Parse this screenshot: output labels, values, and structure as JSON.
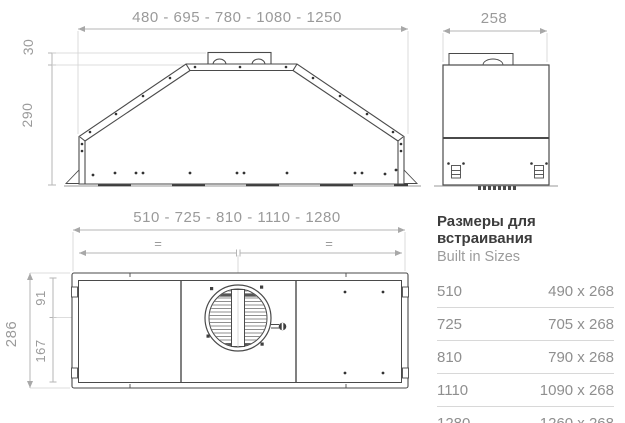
{
  "front_view": {
    "width_series": "480 - 695 - 780 - 1080 - 1250",
    "duct_height": "30",
    "body_height": "290"
  },
  "side_view": {
    "depth": "258"
  },
  "plan_view": {
    "width_series": "510 - 725 - 810 - 1110 - 1280",
    "equal_mark_left": "=",
    "equal_mark_right": "=",
    "depth_total": "286",
    "center_from_front": "91",
    "center_from_back": "167"
  },
  "sizes_table": {
    "title": "Размеры для встраивания",
    "subtitle": "Built in Sizes",
    "rows": [
      {
        "model": "510",
        "cutout": "490 x 268"
      },
      {
        "model": "725",
        "cutout": "705 x 268"
      },
      {
        "model": "810",
        "cutout": "790 x 268"
      },
      {
        "model": "1110",
        "cutout": "1090 x 268"
      },
      {
        "model": "1280",
        "cutout": "1260 x 268"
      }
    ]
  },
  "colors": {
    "background": "#ffffff",
    "drawing_line": "#4a4a4a",
    "dimension_line": "#b5b5b5",
    "dimension_text": "#9a9a9a",
    "table_title": "#3c3c3c",
    "table_text": "#8f8f8f",
    "separator": "#d8d8d8"
  }
}
